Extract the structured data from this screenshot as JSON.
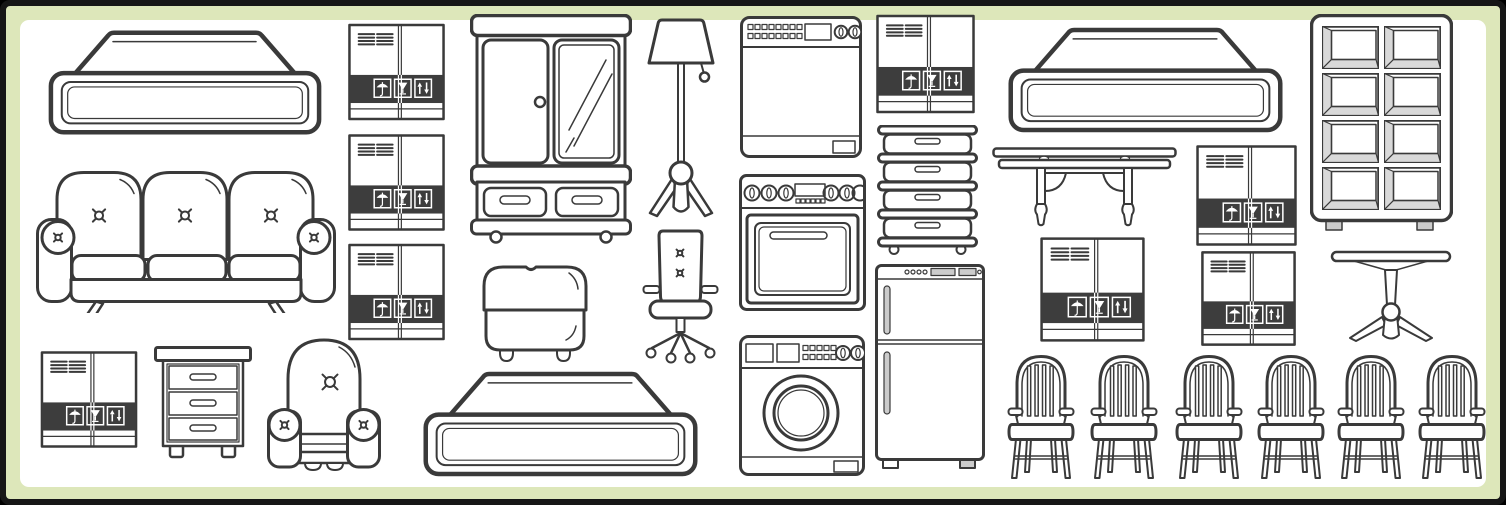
{
  "canvas": {
    "width": 1506,
    "height": 505
  },
  "colors": {
    "outline": "#3a3a3a",
    "label_band": "#3d3d3d",
    "frame_border": "#161616",
    "frame_band": "#dde7ba",
    "paper": "#ffffff",
    "shade": "#d9d9d9",
    "appliance_fill": "#cccccc"
  },
  "box_symbols": [
    "keep-dry-umbrella",
    "fragile-glass",
    "this-way-up-arrows"
  ],
  "items": [
    {
      "name": "mattress-top-left-icon",
      "symbol": "mattress",
      "x": 45,
      "y": 26,
      "w": 280,
      "h": 112
    },
    {
      "name": "sofa-icon",
      "symbol": "sofa",
      "x": 36,
      "y": 167,
      "w": 300,
      "h": 146
    },
    {
      "name": "box-stack-top-icon",
      "symbol": "shipping-box",
      "x": 348,
      "y": 22,
      "w": 97,
      "h": 100
    },
    {
      "name": "box-stack-middle-icon",
      "symbol": "shipping-box",
      "x": 348,
      "y": 132,
      "w": 97,
      "h": 101
    },
    {
      "name": "box-stack-bottom-icon",
      "symbol": "shipping-box",
      "x": 348,
      "y": 242,
      "w": 97,
      "h": 100
    },
    {
      "name": "box-bottom-left-icon",
      "symbol": "shipping-box",
      "x": 38,
      "y": 351,
      "w": 102,
      "h": 97
    },
    {
      "name": "nightstand-icon",
      "symbol": "nightstand",
      "x": 154,
      "y": 346,
      "w": 98,
      "h": 116
    },
    {
      "name": "armchair-icon",
      "symbol": "armchair",
      "x": 267,
      "y": 337,
      "w": 114,
      "h": 135
    },
    {
      "name": "wardrobe-icon",
      "symbol": "wardrobe",
      "x": 470,
      "y": 14,
      "w": 162,
      "h": 230
    },
    {
      "name": "ottoman-icon",
      "symbol": "ottoman",
      "x": 472,
      "y": 260,
      "w": 126,
      "h": 104
    },
    {
      "name": "mattress-bottom-center-icon",
      "symbol": "mattress",
      "x": 419,
      "y": 369,
      "w": 283,
      "h": 109
    },
    {
      "name": "floor-lamp-icon",
      "symbol": "floor-lamp",
      "x": 647,
      "y": 17,
      "w": 68,
      "h": 213
    },
    {
      "name": "office-chair-icon",
      "symbol": "office-chair",
      "x": 642,
      "y": 227,
      "w": 77,
      "h": 141
    },
    {
      "name": "dishwasher-icon",
      "symbol": "dishwasher",
      "x": 740,
      "y": 16,
      "w": 122,
      "h": 142
    },
    {
      "name": "stove-icon",
      "symbol": "stove",
      "x": 739,
      "y": 174,
      "w": 127,
      "h": 137
    },
    {
      "name": "washing-machine-icon",
      "symbol": "washing-machine",
      "x": 739,
      "y": 335,
      "w": 126,
      "h": 141
    },
    {
      "name": "box-middle-top-icon",
      "symbol": "shipping-box",
      "x": 876,
      "y": 13,
      "w": 99,
      "h": 102
    },
    {
      "name": "chest-of-drawers-icon",
      "symbol": "chest-of-drawers",
      "x": 877,
      "y": 125,
      "w": 101,
      "h": 131
    },
    {
      "name": "fridge-icon",
      "symbol": "fridge",
      "x": 875,
      "y": 264,
      "w": 110,
      "h": 209
    },
    {
      "name": "mattress-top-right-icon",
      "symbol": "mattress",
      "x": 1002,
      "y": 25,
      "w": 287,
      "h": 109
    },
    {
      "name": "console-table-icon",
      "symbol": "console-table",
      "x": 992,
      "y": 147,
      "w": 185,
      "h": 86
    },
    {
      "name": "box-center-right-icon",
      "symbol": "shipping-box",
      "x": 1040,
      "y": 237,
      "w": 105,
      "h": 105
    },
    {
      "name": "box-right-upper-icon",
      "symbol": "shipping-box",
      "x": 1196,
      "y": 142,
      "w": 101,
      "h": 107
    },
    {
      "name": "box-right-lower-icon",
      "symbol": "shipping-box",
      "x": 1196,
      "y": 251,
      "w": 105,
      "h": 95
    },
    {
      "name": "shelving-unit-icon",
      "symbol": "shelving-unit",
      "x": 1310,
      "y": 14,
      "w": 143,
      "h": 220
    },
    {
      "name": "pedestal-table-icon",
      "symbol": "pedestal-table",
      "x": 1330,
      "y": 249,
      "w": 123,
      "h": 96
    },
    {
      "name": "dining-chair-1-icon",
      "symbol": "dining-chair",
      "x": 1007,
      "y": 352,
      "w": 68,
      "h": 130
    },
    {
      "name": "dining-chair-2-icon",
      "symbol": "dining-chair",
      "x": 1090,
      "y": 352,
      "w": 68,
      "h": 130
    },
    {
      "name": "dining-chair-3-icon",
      "symbol": "dining-chair",
      "x": 1175,
      "y": 352,
      "w": 68,
      "h": 130
    },
    {
      "name": "dining-chair-4-icon",
      "symbol": "dining-chair",
      "x": 1257,
      "y": 352,
      "w": 68,
      "h": 130
    },
    {
      "name": "dining-chair-5-icon",
      "symbol": "dining-chair",
      "x": 1337,
      "y": 352,
      "w": 68,
      "h": 130
    },
    {
      "name": "dining-chair-6-icon",
      "symbol": "dining-chair",
      "x": 1418,
      "y": 352,
      "w": 68,
      "h": 130
    }
  ]
}
